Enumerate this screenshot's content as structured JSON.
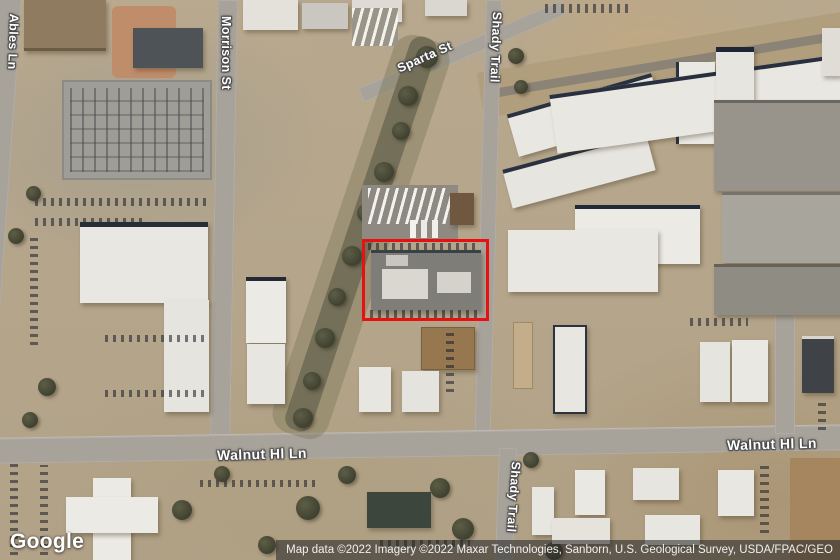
{
  "map": {
    "view_type": "satellite",
    "highlight": {
      "shape": "rectangle",
      "color": "#e81010"
    },
    "road_labels": {
      "ables_ln": "Ables Ln",
      "morrison_st": "Morrison St",
      "sparta_st": "Sparta St",
      "shady_trail_top": "Shady Trail",
      "shady_trail_bottom": "Shady Trail",
      "walnut_hl_ln_left": "Walnut Hl Ln",
      "walnut_hl_ln_right": "Walnut Hl Ln"
    }
  },
  "branding": {
    "logo_text": "Google"
  },
  "attribution": {
    "text": "Map data ©2022 Imagery ©2022 Maxar Technologies, Sanborn, U.S. Geological Survey, USDA/FPAC/GEO"
  }
}
